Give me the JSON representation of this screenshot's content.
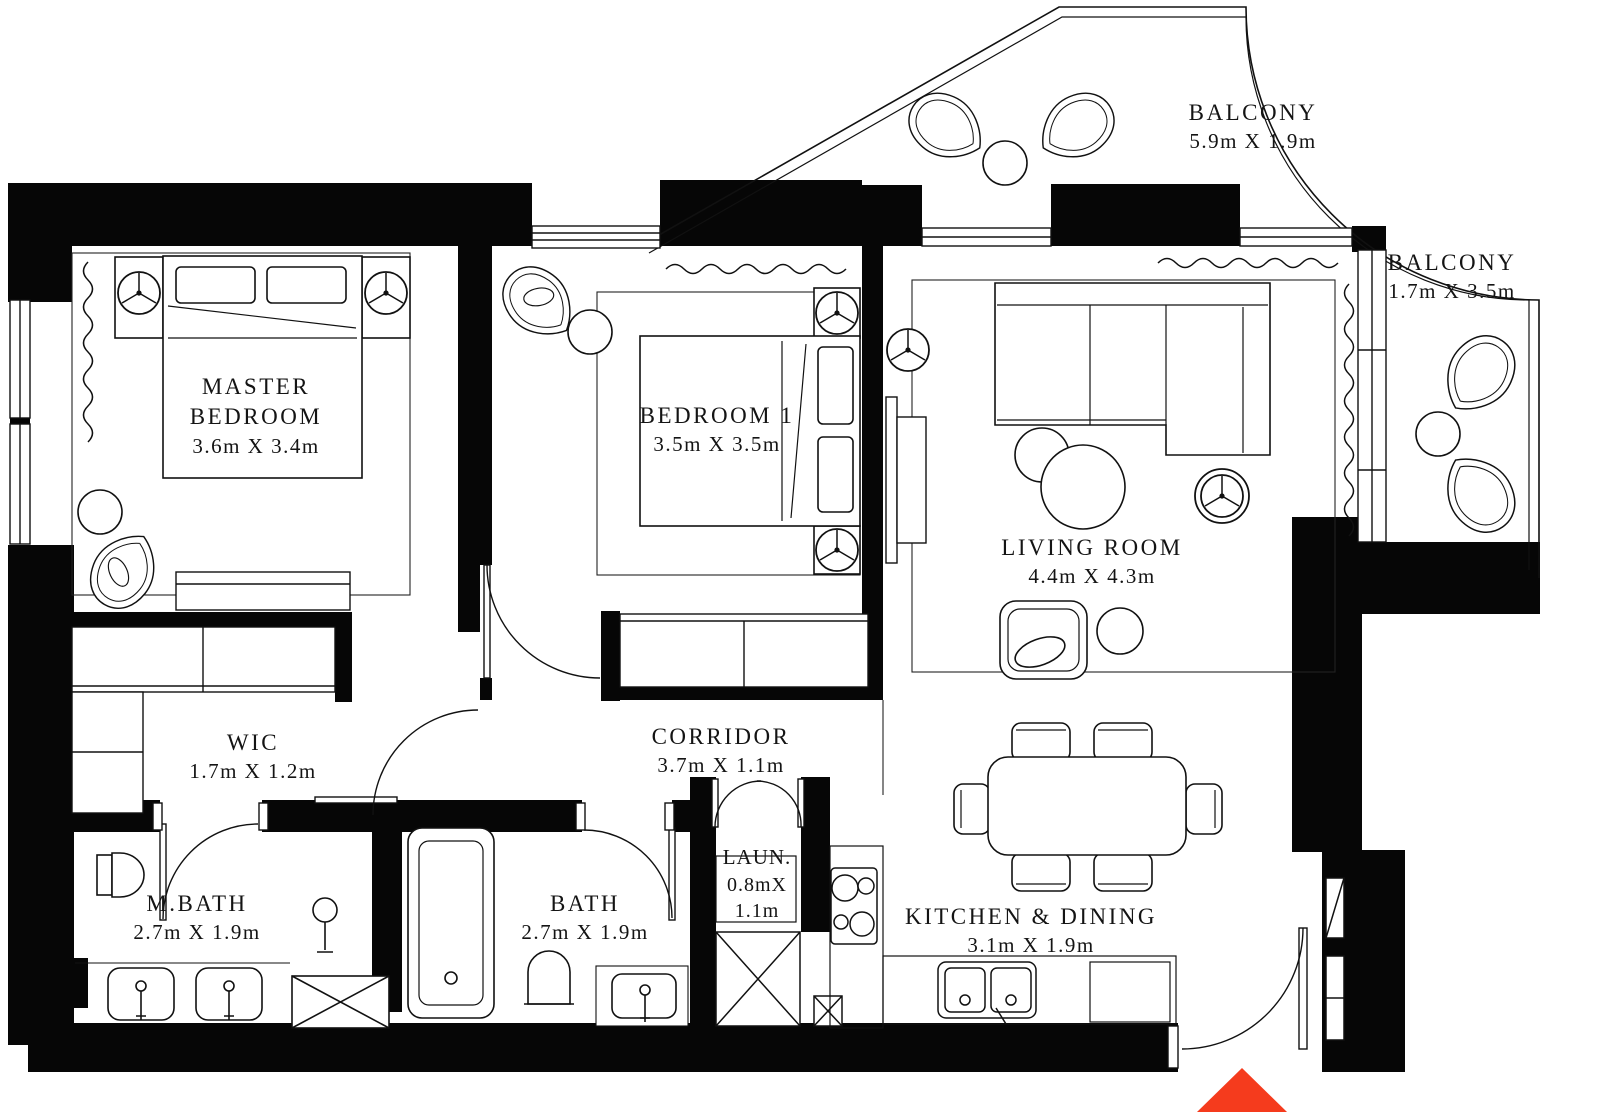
{
  "floorplan": {
    "entrance_color": "#f53b1d",
    "rooms": [
      {
        "id": "master-bedroom",
        "name": "MASTER",
        "name2": "BEDROOM",
        "dims": "3.6m X 3.4m"
      },
      {
        "id": "bedroom-1",
        "name": "BEDROOM 1",
        "dims": "3.5m X 3.5m"
      },
      {
        "id": "living-room",
        "name": "LIVING ROOM",
        "dims": "4.4m X 4.3m"
      },
      {
        "id": "balcony-top",
        "name": "BALCONY",
        "dims": "5.9m X 1.9m"
      },
      {
        "id": "balcony-right",
        "name": "BALCONY",
        "dims": "1.7m X 3.5m"
      },
      {
        "id": "wic",
        "name": "WIC",
        "dims": "1.7m X 1.2m"
      },
      {
        "id": "corridor",
        "name": "CORRIDOR",
        "dims": "3.7m X 1.1m"
      },
      {
        "id": "m-bath",
        "name": "M.BATH",
        "dims": "2.7m X 1.9m"
      },
      {
        "id": "bath",
        "name": "BATH",
        "dims": "2.7m X 1.9m"
      },
      {
        "id": "laundry",
        "name": "LAUN.",
        "dims": "0.8mX",
        "dims2": "1.1m"
      },
      {
        "id": "kitchen-dining",
        "name": "KITCHEN & DINING",
        "dims": "3.1m X 1.9m"
      }
    ]
  }
}
